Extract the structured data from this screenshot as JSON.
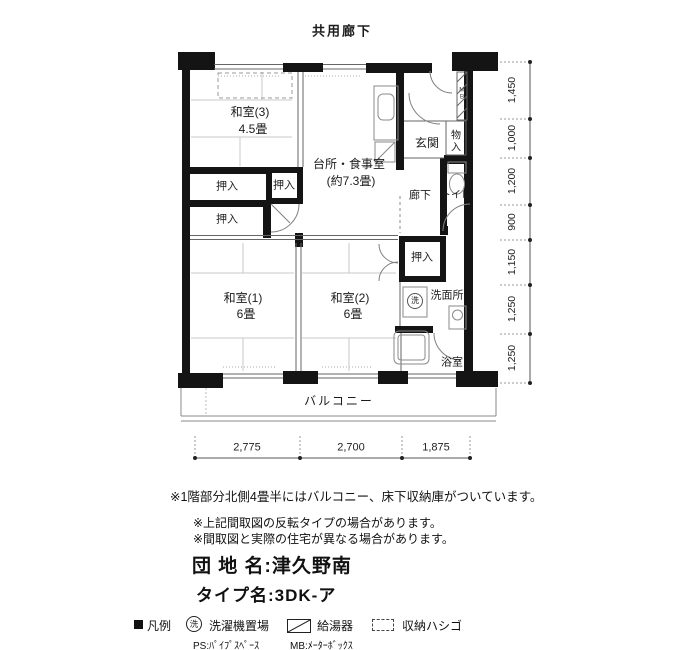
{
  "header": {
    "top_corridor": "共用廊下"
  },
  "plan": {
    "washitsu3": {
      "name": "和室(3)",
      "size": "4.5畳"
    },
    "dk": {
      "name": "台所・食事室",
      "size": "(約7.3畳)"
    },
    "oshiire": "押入",
    "genkan": "玄関",
    "monoiri": "物入",
    "rouka": "廊下",
    "toilet": "トイレ",
    "mb_mark": "MB",
    "washitsu1": {
      "name": "和室(1)",
      "size": "6畳"
    },
    "washitsu2": {
      "name": "和室(2)",
      "size": "6畳"
    },
    "sen_mark": "洗",
    "senmenjo": "洗面所",
    "yokushitsu": "浴室",
    "balcony": "バルコニー"
  },
  "dimensions": {
    "right": [
      "1,450",
      "1,000",
      "1,200",
      "900",
      "1,150",
      "1,250",
      "1,250"
    ],
    "bottom": [
      "2,775",
      "2,700",
      "1,875"
    ]
  },
  "notes": [
    "※1階部分北側4畳半にはバルコニー、床下収納庫がついています。",
    "※上記間取図の反転タイプの場合があります。",
    "※間取図と実際の住宅が異なる場合があります。"
  ],
  "info": {
    "danchi": "団 地 名:津久野南",
    "type": "タイプ名:3DK-ア"
  },
  "legend": {
    "heading": "凡例",
    "sen_mark": "洗",
    "sentakuki": "洗濯機置場",
    "kyutoki": "給湯器",
    "shunou": "収納ハシゴ",
    "ps": "PS:ﾊﾟｲﾌﾟｽﾍﾟｰｽ",
    "mb": "MB:ﾒｰﾀｰﾎﾞｯｸｽ"
  }
}
